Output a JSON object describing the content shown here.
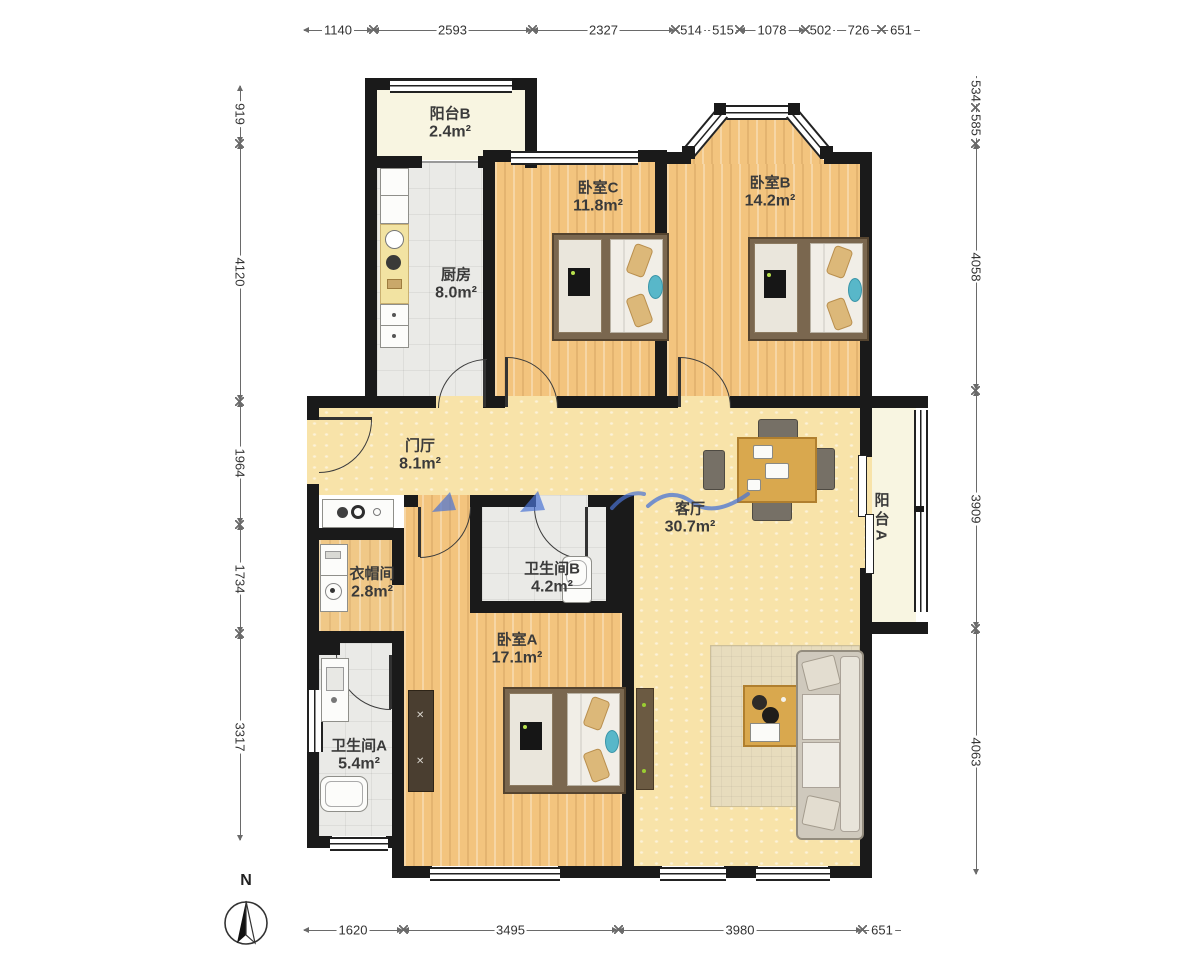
{
  "plan_type": "apartment-floor-plan",
  "compass": {
    "label": "N"
  },
  "rooms": {
    "balcony_b": {
      "name": "阳台B",
      "area": "2.4m²"
    },
    "kitchen": {
      "name": "厨房",
      "area": "8.0m²"
    },
    "bedroom_c": {
      "name": "卧室C",
      "area": "11.8m²"
    },
    "bedroom_b": {
      "name": "卧室B",
      "area": "14.2m²"
    },
    "hall": {
      "name": "门厅",
      "area": "8.1m²"
    },
    "living": {
      "name": "客厅",
      "area": "30.7m²"
    },
    "balcony_a": {
      "name": "阳台A"
    },
    "cloakroom": {
      "name": "衣帽间",
      "area": "2.8m²"
    },
    "bathroom_b": {
      "name": "卫生间B",
      "area": "4.2m²"
    },
    "bedroom_a": {
      "name": "卧室A",
      "area": "17.1m²"
    },
    "bathroom_a": {
      "name": "卫生间A",
      "area": "5.4m²"
    }
  },
  "dimensions": {
    "top": [
      "1140",
      "2593",
      "2327",
      "514",
      "515",
      "1078",
      "502",
      "726",
      "651"
    ],
    "bottom": [
      "1620",
      "3495",
      "3980",
      "651"
    ],
    "left": [
      "919",
      "4120",
      "1964",
      "1734",
      "3317"
    ],
    "right": [
      "534",
      "585",
      "4058",
      "3909",
      "4063"
    ]
  },
  "colors": {
    "wall": "#1a1a1a",
    "wood_floor": "#F3C47E",
    "tile_floor": "#EAEAE7",
    "hall_floor": "#F8E3A9",
    "balcony_floor": "#F8F5E1",
    "annotation_blue": "#4a74d4"
  }
}
